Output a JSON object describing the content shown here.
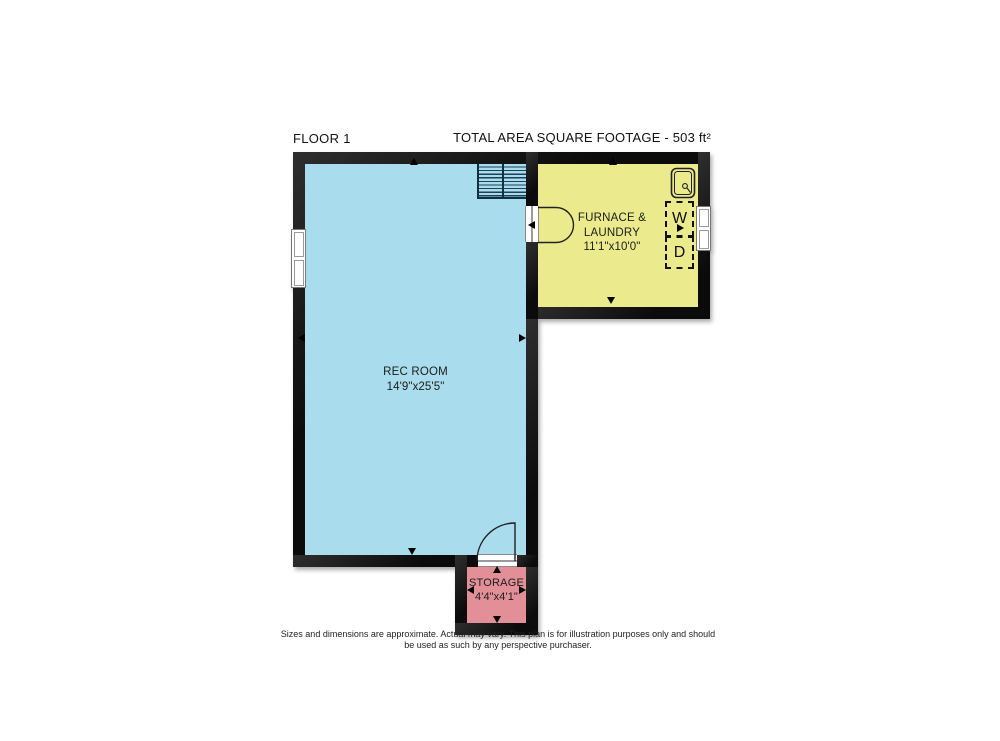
{
  "header": {
    "floor_label": "FLOOR 1",
    "total_area_label": "TOTAL AREA SQUARE FOOTAGE - 503 ft²"
  },
  "rooms": {
    "rec_room": {
      "name": "REC ROOM",
      "dimensions": "14'9\"x25'5\""
    },
    "furnace_laundry": {
      "name": "FURNACE & LAUNDRY",
      "dimensions": "11'1\"x10'0\""
    },
    "storage": {
      "name": "STORAGE",
      "dimensions": "4'4\"x4'1\""
    }
  },
  "fixtures": {
    "washer_label": "W",
    "dryer_label": "D",
    "sink_icon": "sink-icon",
    "stairs": "staircase"
  },
  "footer": {
    "disclaimer": "Sizes and dimensions are approximate. Actual may vary. This plan is for illustration purposes only and should be used as such by any perspective purchaser."
  },
  "colors": {
    "rec_room_fill": "#a9dcec",
    "furnace_laundry_fill": "#ebeb8d",
    "storage_fill": "#e28f98",
    "wall": "#141414",
    "stairs_tread": "#1d4156"
  }
}
